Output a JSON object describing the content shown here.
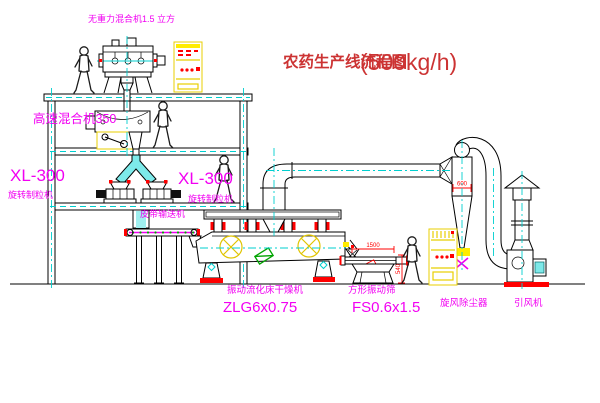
{
  "colors": {
    "background": "#ffffff",
    "line": "#000000",
    "centerline_cyan": "#00cfcf",
    "equipment_yellow": "#ffec00",
    "label_magenta": "#f200f2",
    "dimension_red": "#ff0000",
    "title_red": "#cc3333",
    "motor_green": "#00a400"
  },
  "title": {
    "text": "农药生产线流程图",
    "capacity": "(500kg/h)"
  },
  "labels": {
    "gravity_mixer": "无重力混合机1.5 立方",
    "high_speed_mixer": "高速混合机350",
    "granulator_left": {
      "model": "XL-300",
      "name": "旋转制粒机"
    },
    "granulator_right": {
      "model": "XL-300",
      "name": "旋转制粒机"
    },
    "belt_conveyor": "皮带输送机",
    "dryer": {
      "name": "振动流化床干燥机",
      "model": "ZLG6x0.75"
    },
    "screen": {
      "name": "方形振动筛",
      "model": "FS0.6x1.5"
    },
    "cyclone": "旋风除尘器",
    "fan": "引风机"
  },
  "dimensions": {
    "cyclone_outlet": "600",
    "screen_length": "1500",
    "screen_height": "540"
  },
  "icons": {
    "worker": "worker-silhouette"
  }
}
